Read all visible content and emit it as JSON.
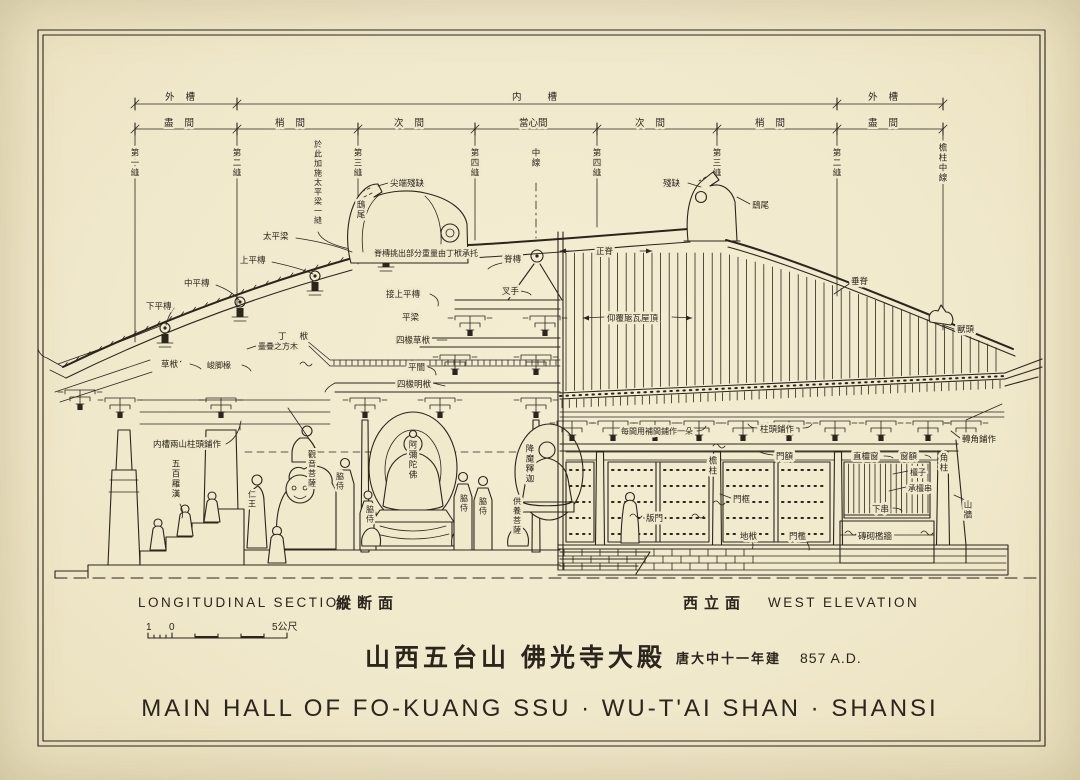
{
  "colors": {
    "paper": "#f1e9cc",
    "ink": "#2b251c"
  },
  "header": {
    "zones": [
      "外槽",
      "内槽",
      "外槽"
    ],
    "bays": [
      "盡間",
      "梢間",
      "次間",
      "當心間",
      "次間",
      "梢間",
      "盡間"
    ],
    "grid_lines": [
      "第一縫",
      "第二縫",
      "第三縫",
      "第四縫",
      "中線",
      "第四縫",
      "第三縫",
      "第二縫",
      "檐柱中線"
    ],
    "note": "於此加施太平梁一縫"
  },
  "section": {
    "tip_damaged": "尖端殘缺",
    "chiwei": "鴟尾",
    "taiping_beam": "太平梁",
    "upper_purlin": "上平槫",
    "middle_purlin": "中平槫",
    "lower_purlin": "下平槫",
    "ridge_note": "脊槫挑出部分重量由丁栿承托",
    "ridge_purlin": "脊槫",
    "chashou": "叉手",
    "join_upper_purlin": "接上平槫",
    "pingliang": "平梁",
    "four_rafter_rough_beam": "四椽草栿",
    "ding_fu": "丁栿",
    "stacked_timbers": "壘疊之方木",
    "rough_beam": "草栿",
    "junjiao_rafters": "峻脚椽",
    "pingan_ceiling": "平闇",
    "four_rafter_exposed_beam": "四椽明栿",
    "inner_cao_brackets": "内槽兩山柱頭鋪作",
    "arhats": "五百羅漢",
    "renwang": "仁王",
    "guanyin": "觀音菩薩",
    "attendant": "脇侍",
    "amitabha": "阿彌陀佛",
    "sakyamuni": "降魔釋迦",
    "offering_bodhisattva": "供養菩薩"
  },
  "elevation": {
    "damaged": "殘缺",
    "chiwei": "鴟尾",
    "main_ridge": "正脊",
    "descending_ridge": "垂脊",
    "tile_roof": "仰覆瓪瓦屋頂",
    "beast_head": "獸頭",
    "intermediate_brackets": "每間用補間鋪作一朵",
    "column_top_brackets": "柱頭鋪作",
    "corner_brackets": "轉角鋪作",
    "door_lintel": "門額",
    "eave_column": "檐柱",
    "door_jamb": "門框",
    "plank_door": "版門",
    "ground_sill": "地栿",
    "threshold": "門檻",
    "lattice_window": "直欞窗",
    "window_lintel": "窗額",
    "lattice_bars": "欞子",
    "lattice_rail": "承欞串",
    "lower_rail": "下串",
    "corner_column": "角柱",
    "gable_wall": "山牆",
    "brick_sill_wall": "磚砌檻牆"
  },
  "captions": {
    "section_en": "LONGITUDINAL SECTION",
    "section_cjk": "縱断面",
    "elevation_cjk": "西立面",
    "elevation_en": "WEST ELEVATION"
  },
  "scalebar": {
    "one": "1",
    "zero": "0",
    "five": "5公尺"
  },
  "titleblock": {
    "title_cjk": "山西五台山 佛光寺大殿",
    "date_cjk": "唐大中十一年建",
    "date_en": "857 A.D.",
    "title_en": "MAIN HALL OF FO-KUANG SSU · WU-T'AI SHAN · SHANSI"
  }
}
